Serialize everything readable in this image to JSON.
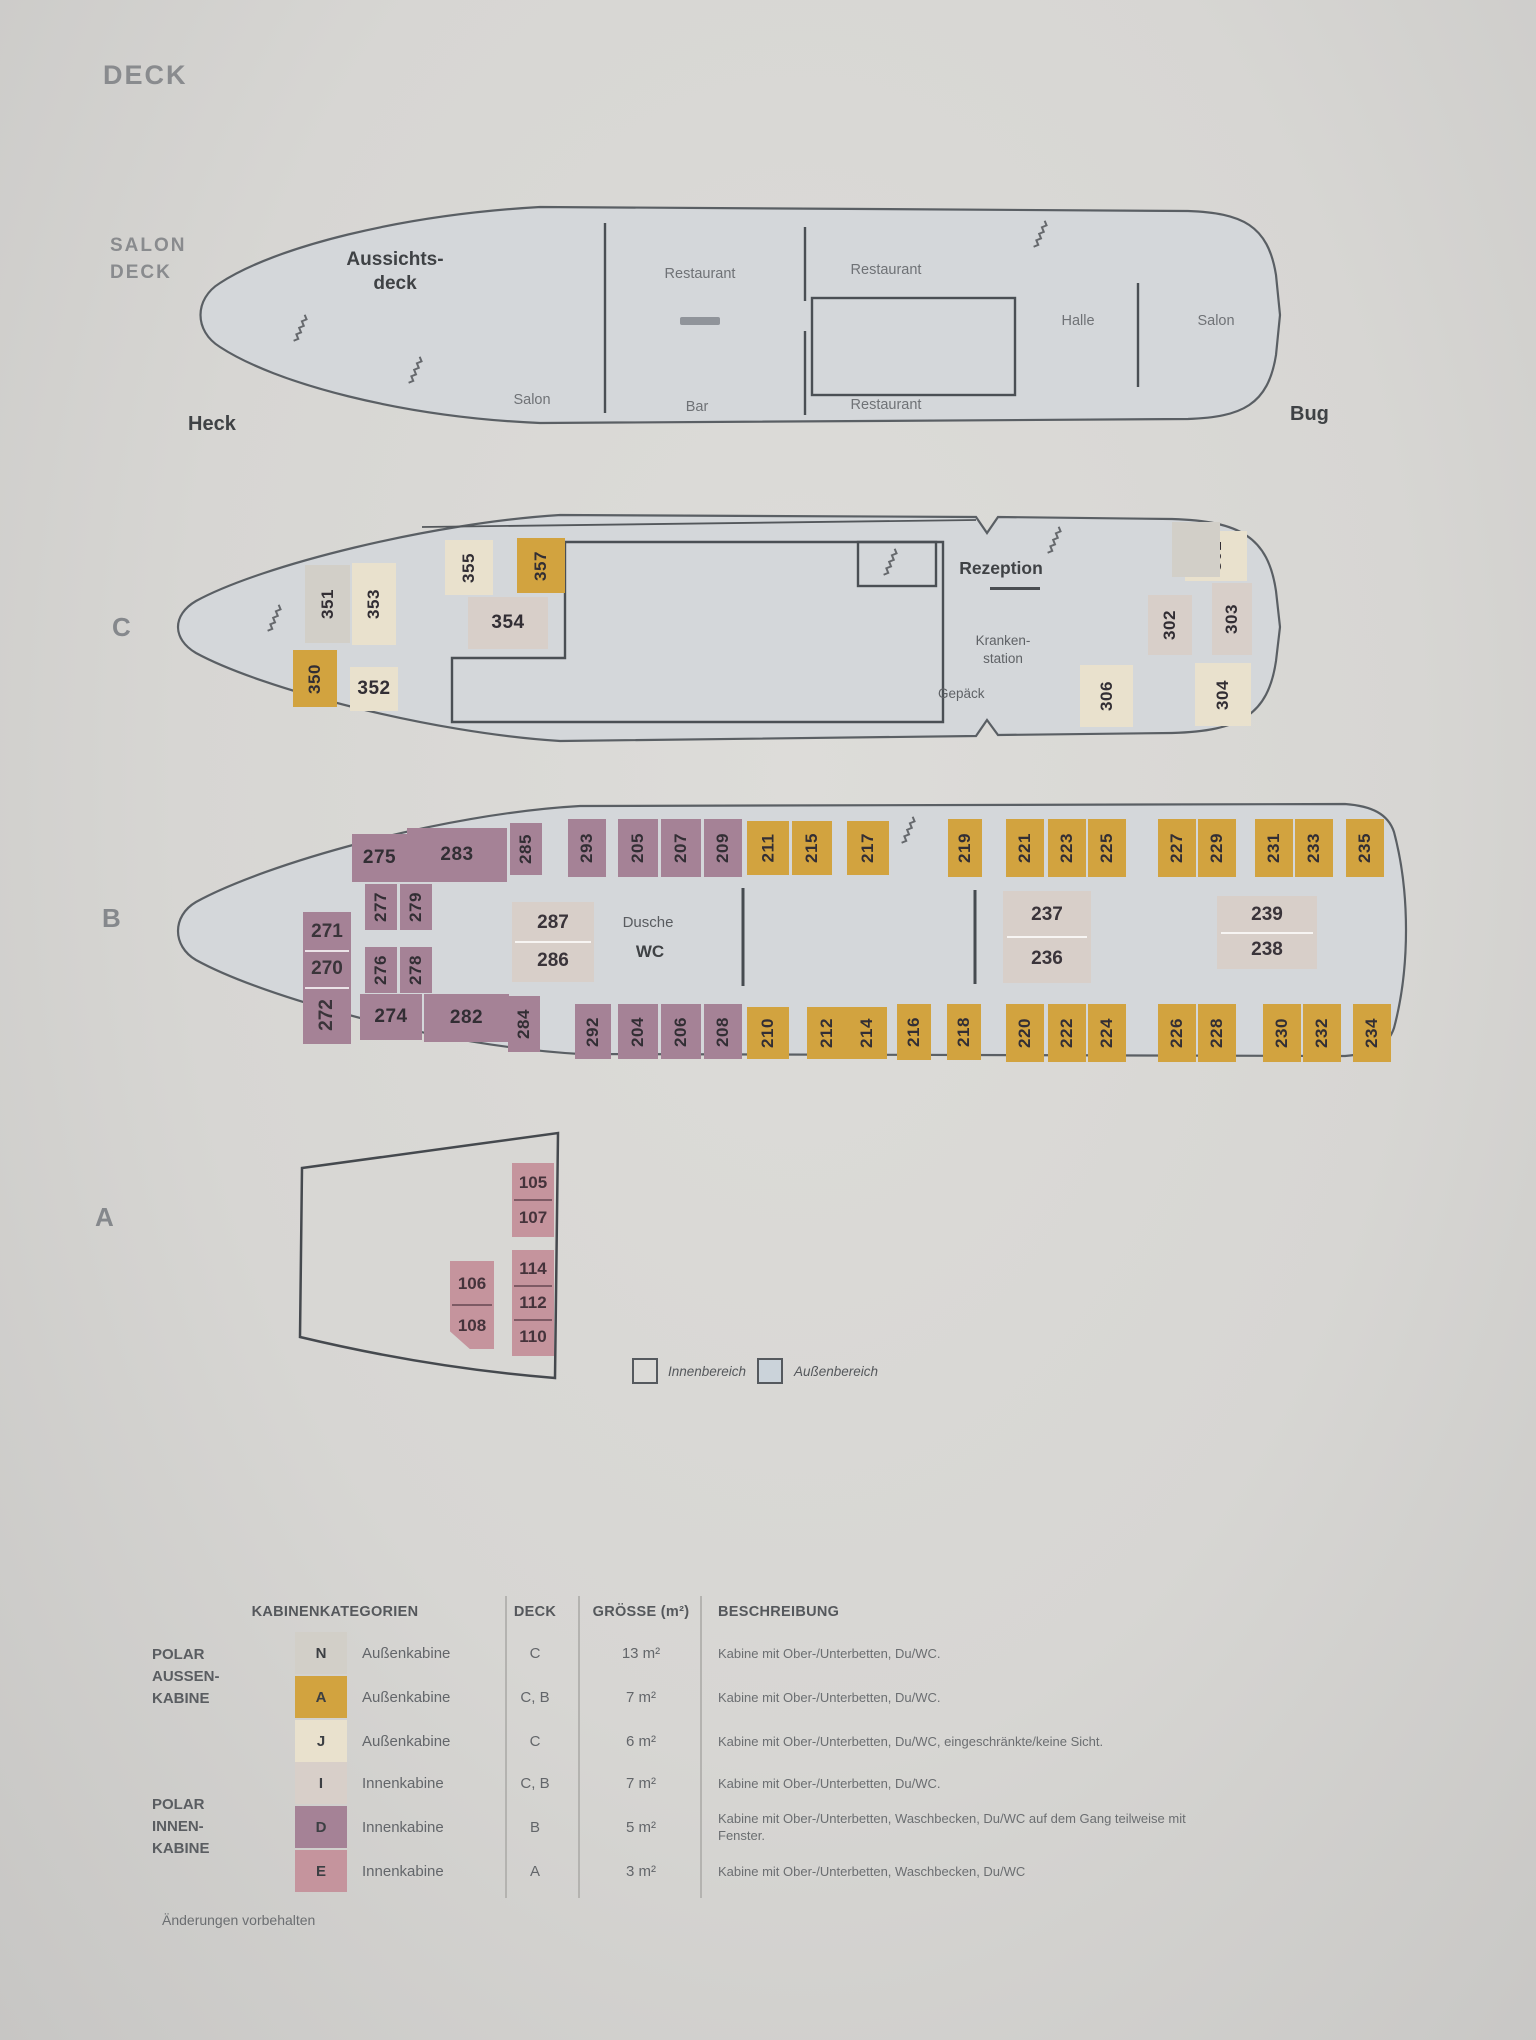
{
  "title": "DECK",
  "salon_deck": {
    "label": [
      "SALON",
      "DECK"
    ],
    "aussichtsdeck": [
      "Aussichts-",
      "deck"
    ],
    "salon_aft": "Salon",
    "restaurant_mid_top": "Restaurant",
    "bar": "Bar",
    "restaurant_fwd_top": "Restaurant",
    "restaurant_fwd_bottom": "Restaurant",
    "halle": "Halle",
    "salon_fwd": "Salon",
    "heck": "Heck",
    "bug": "Bug"
  },
  "deck_c": {
    "label": "C",
    "rezeption": "Rezeption",
    "krankenstation": [
      "Kranken-",
      "station"
    ],
    "gepaeck": "Gepäck",
    "cabins": [
      {
        "number": "351",
        "category": "N"
      },
      {
        "number": "353",
        "category": "J"
      },
      {
        "number": "350",
        "category": "A"
      },
      {
        "number": "352",
        "category": "J"
      },
      {
        "number": "355",
        "category": "J"
      },
      {
        "number": "357",
        "category": "A"
      },
      {
        "number": "354",
        "category": "I"
      },
      {
        "number": "301",
        "category": "J"
      },
      {
        "number": "302",
        "category": "I"
      },
      {
        "number": "303",
        "category": "I"
      },
      {
        "number": "304",
        "category": "J"
      },
      {
        "number": "306",
        "category": "J"
      }
    ]
  },
  "deck_b": {
    "label": "B",
    "dusche": "Dusche",
    "wc": "WC",
    "cabins": [
      {
        "number": "275",
        "category": "D"
      },
      {
        "number": "283",
        "category": "D"
      },
      {
        "number": "285",
        "category": "D"
      },
      {
        "number": "293",
        "category": "D"
      },
      {
        "number": "205",
        "category": "D"
      },
      {
        "number": "207",
        "category": "D"
      },
      {
        "number": "209",
        "category": "D"
      },
      {
        "number": "211",
        "category": "A"
      },
      {
        "number": "215",
        "category": "A"
      },
      {
        "number": "217",
        "category": "A"
      },
      {
        "number": "219",
        "category": "A"
      },
      {
        "number": "221",
        "category": "A"
      },
      {
        "number": "223",
        "category": "A"
      },
      {
        "number": "225",
        "category": "A"
      },
      {
        "number": "227",
        "category": "A"
      },
      {
        "number": "229",
        "category": "A"
      },
      {
        "number": "231",
        "category": "A"
      },
      {
        "number": "233",
        "category": "A"
      },
      {
        "number": "235",
        "category": "A"
      },
      {
        "number": "277",
        "category": "D"
      },
      {
        "number": "279",
        "category": "D"
      },
      {
        "number": "276",
        "category": "D"
      },
      {
        "number": "278",
        "category": "D"
      },
      {
        "numbers": [
          "271",
          "270",
          "272"
        ],
        "category": "D"
      },
      {
        "numbers": [
          "287",
          "286"
        ],
        "category": "I"
      },
      {
        "numbers": [
          "237",
          "236"
        ],
        "category": "I"
      },
      {
        "numbers": [
          "239",
          "238"
        ],
        "category": "I"
      },
      {
        "number": "274",
        "category": "D"
      },
      {
        "number": "282",
        "category": "D"
      },
      {
        "number": "284",
        "category": "D"
      },
      {
        "number": "292",
        "category": "D"
      },
      {
        "number": "204",
        "category": "D"
      },
      {
        "number": "206",
        "category": "D"
      },
      {
        "number": "208",
        "category": "D"
      },
      {
        "number": "210",
        "category": "A"
      },
      {
        "number": "212",
        "category": "A"
      },
      {
        "number": "214",
        "category": "A"
      },
      {
        "number": "216",
        "category": "A"
      },
      {
        "number": "218",
        "category": "A"
      },
      {
        "number": "220",
        "category": "A"
      },
      {
        "number": "222",
        "category": "A"
      },
      {
        "number": "224",
        "category": "A"
      },
      {
        "number": "226",
        "category": "A"
      },
      {
        "number": "228",
        "category": "A"
      },
      {
        "number": "230",
        "category": "A"
      },
      {
        "number": "232",
        "category": "A"
      },
      {
        "number": "234",
        "category": "A"
      }
    ]
  },
  "deck_a": {
    "label": "A",
    "cabins": [
      {
        "numbers": [
          "105",
          "107"
        ],
        "category": "E"
      },
      {
        "numbers": [
          "106",
          "108"
        ],
        "category": "E"
      },
      {
        "numbers": [
          "114",
          "112",
          "110"
        ],
        "category": "E"
      }
    ]
  },
  "area_legend": {
    "innenbereich": "Innenbereich",
    "aussenbereich": "Außenbereich"
  },
  "categories_table": {
    "headers": {
      "categories": "KABINENKATEGORIEN",
      "deck": "DECK",
      "size": "GRÖSSE (m²)",
      "description": "BESCHREIBUNG"
    },
    "groups": [
      {
        "group_label": [
          "POLAR",
          "AUSSEN-",
          "KABINE"
        ],
        "rows": [
          {
            "code": "N",
            "type": "Außenkabine",
            "deck": "C",
            "size": "13 m²",
            "description": "Kabine mit Ober-/Unterbetten, Du/WC."
          },
          {
            "code": "A",
            "type": "Außenkabine",
            "deck": "C, B",
            "size": "7 m²",
            "description": "Kabine mit Ober-/Unterbetten, Du/WC."
          },
          {
            "code": "J",
            "type": "Außenkabine",
            "deck": "C",
            "size": "6 m²",
            "description": "Kabine mit Ober-/Unterbetten, Du/WC, eingeschränkte/keine Sicht."
          }
        ]
      },
      {
        "group_label": [
          "POLAR",
          "INNEN-",
          "KABINE"
        ],
        "rows": [
          {
            "code": "I",
            "type": "Innenkabine",
            "deck": "C, B",
            "size": "7 m²",
            "description": "Kabine mit Ober-/Unterbetten, Du/WC."
          },
          {
            "code": "D",
            "type": "Innenkabine",
            "deck": "B",
            "size": "5 m²",
            "description": "Kabine mit Ober-/Unterbetten, Waschbecken, Du/WC auf dem Gang teilweise mit Fenster."
          },
          {
            "code": "E",
            "type": "Innenkabine",
            "deck": "A",
            "size": "3 m²",
            "description": "Kabine mit Ober-/Unterbetten, Waschbecken, Du/WC"
          }
        ]
      }
    ]
  },
  "footer_note": "Änderungen vorbehalten",
  "colors": {
    "N": "#d2cfc8",
    "A": "#d2a33f",
    "J": "#e9e1cd",
    "I": "#d8cfc9",
    "D": "#a58296",
    "E": "#c5949d",
    "innen_box": "#dbdad7",
    "aussen_box": "#cbd3da"
  }
}
